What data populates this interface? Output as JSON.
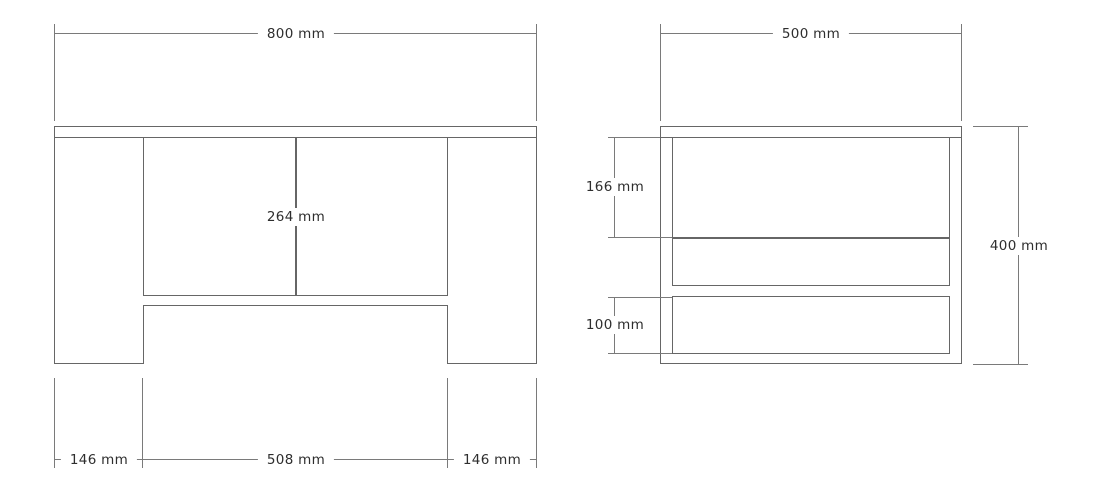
{
  "drawing": {
    "front_view": {
      "overall_width_label": "800 mm",
      "shelf_height_label": "264 mm",
      "left_leg_width_label": "146 mm",
      "inner_span_label": "508 mm",
      "right_leg_width_label": "146 mm"
    },
    "side_view": {
      "overall_depth_label": "500 mm",
      "upper_gap_label": "166 mm",
      "lower_gap_label": "100 mm",
      "overall_height_label": "400 mm"
    },
    "colors": {
      "outline": "#666666",
      "dimension_line": "#7a7a7a",
      "label_text": "#2e2e2e",
      "background": "#ffffff"
    }
  }
}
